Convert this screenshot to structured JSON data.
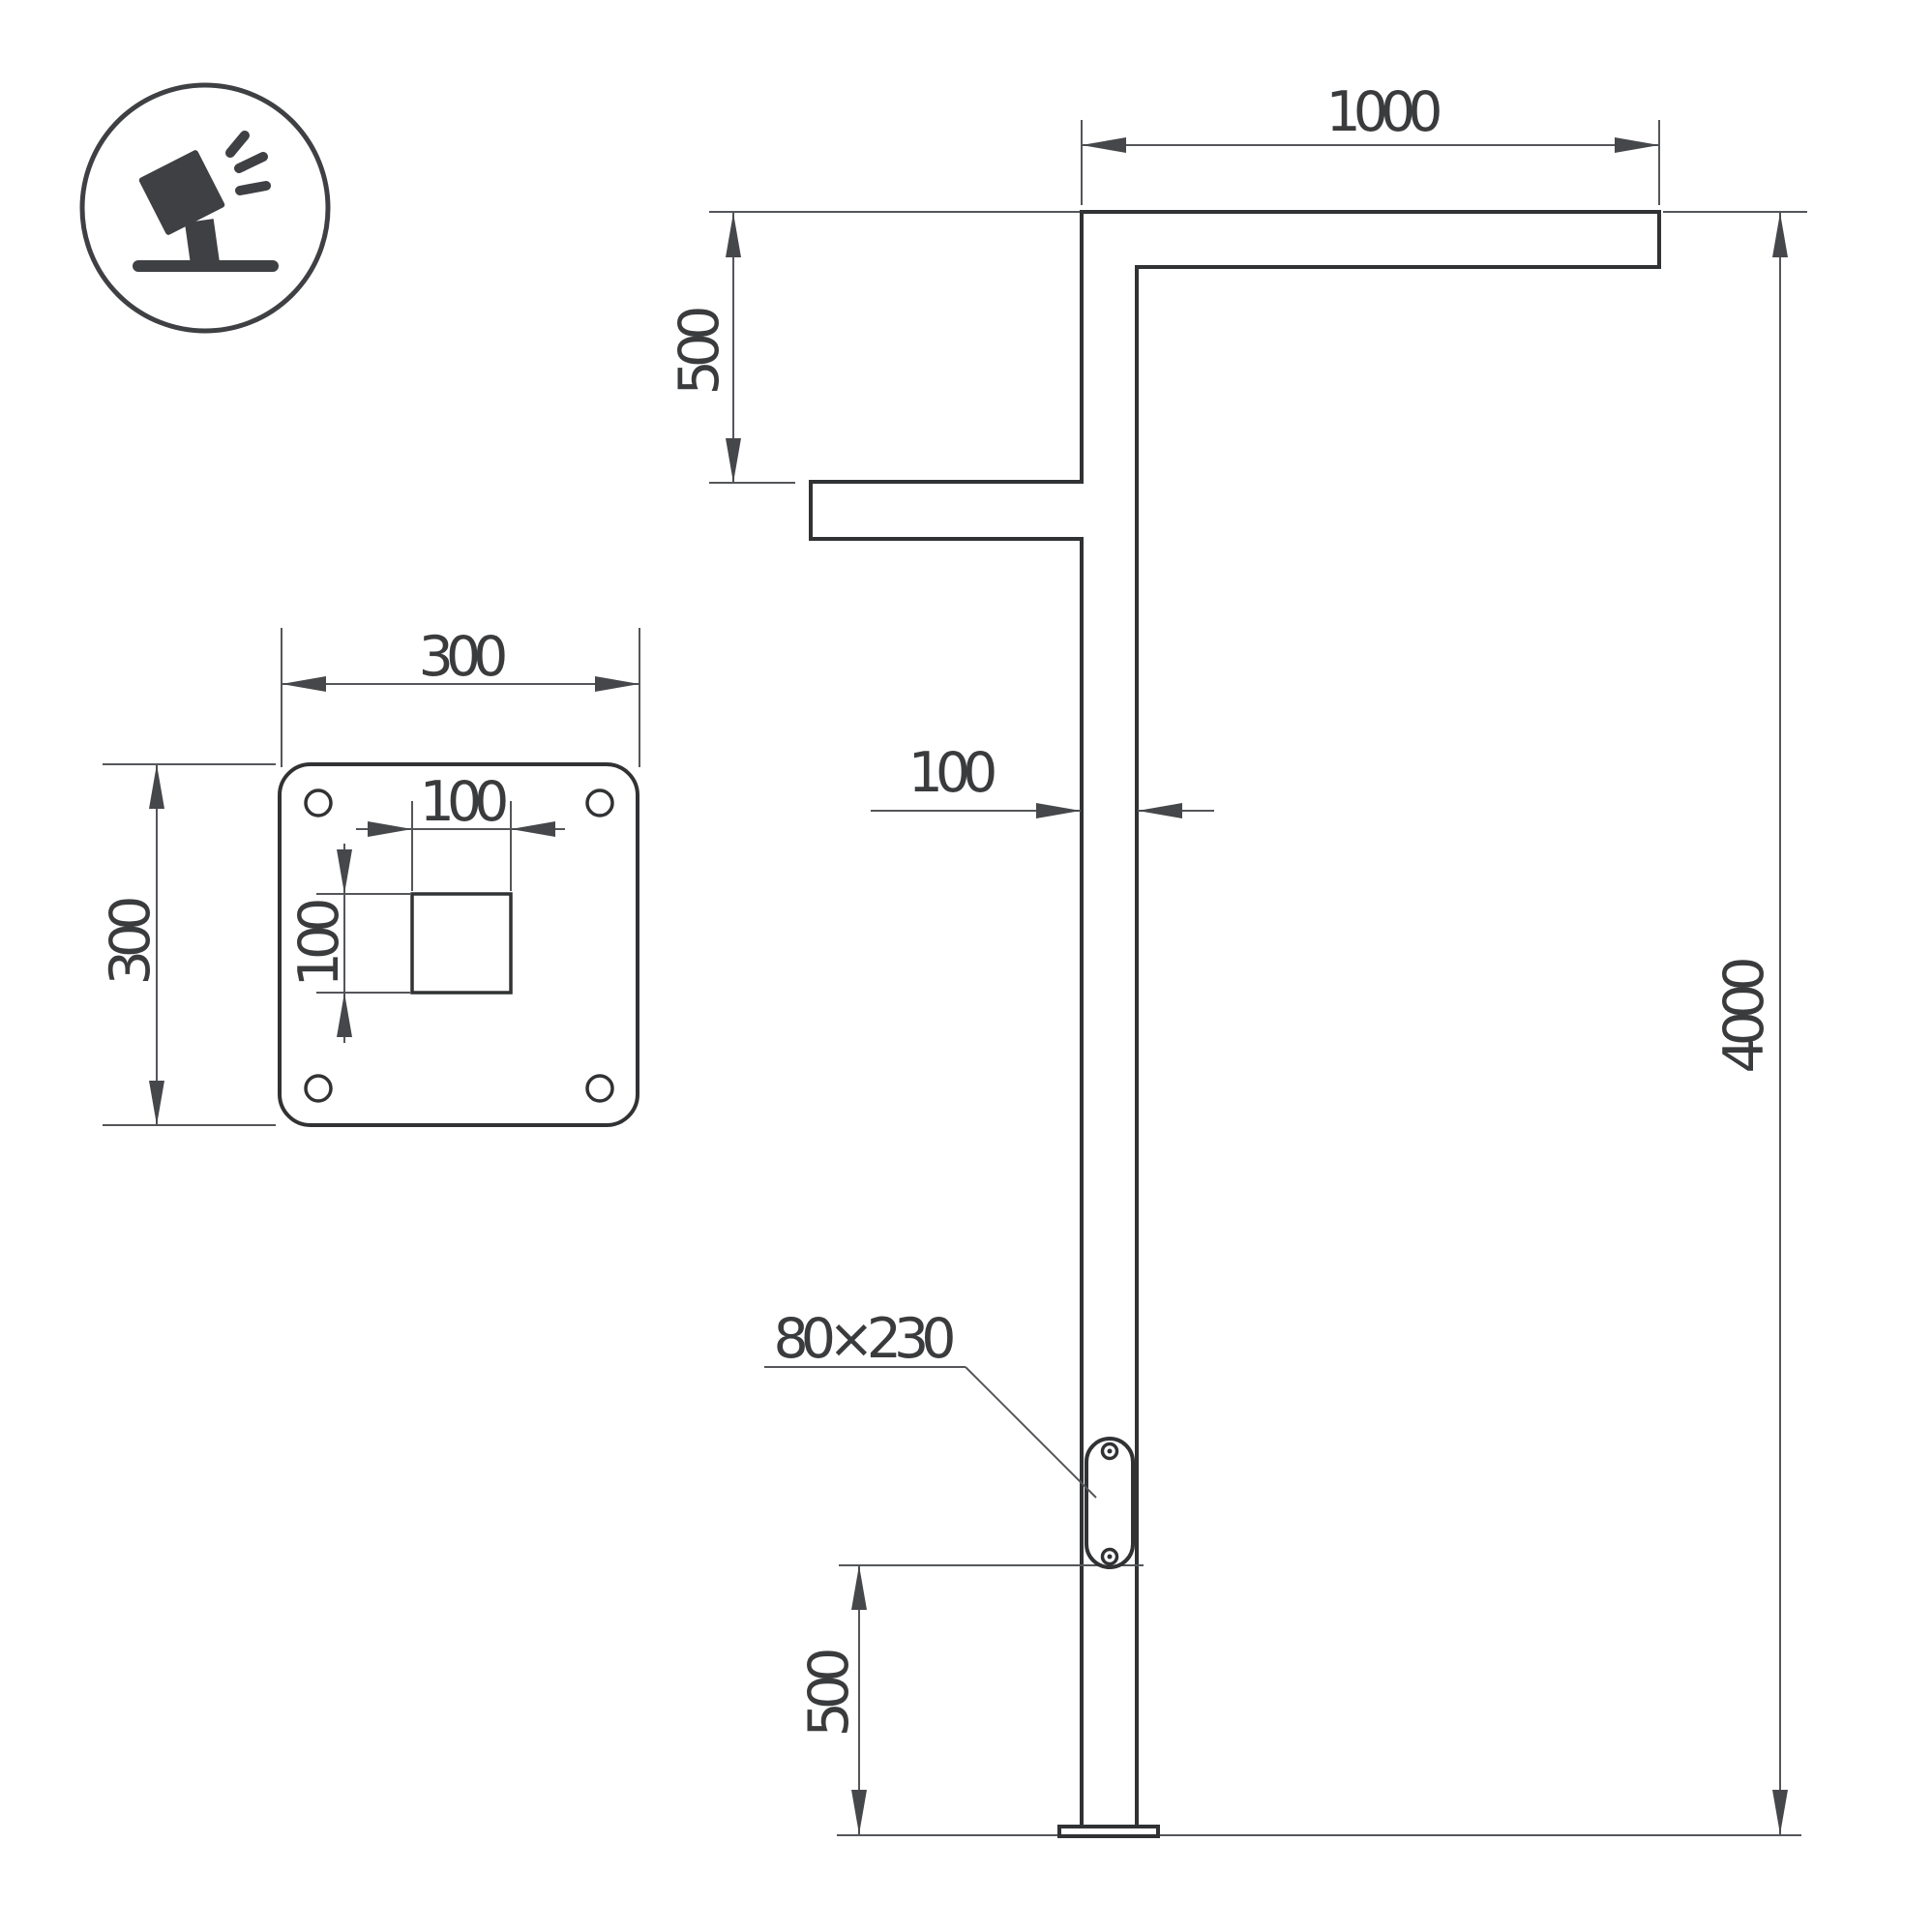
{
  "drawing": {
    "icon": {
      "name": "floodlight-icon"
    },
    "dimensions": {
      "arm_length": "1000",
      "arm_drop": "500",
      "pole_width": "100",
      "pole_height": "4000",
      "door_size": "80×230",
      "door_height": "500",
      "plate_width": "300",
      "plate_height": "300",
      "hole_width": "100",
      "hole_height": "100"
    }
  }
}
